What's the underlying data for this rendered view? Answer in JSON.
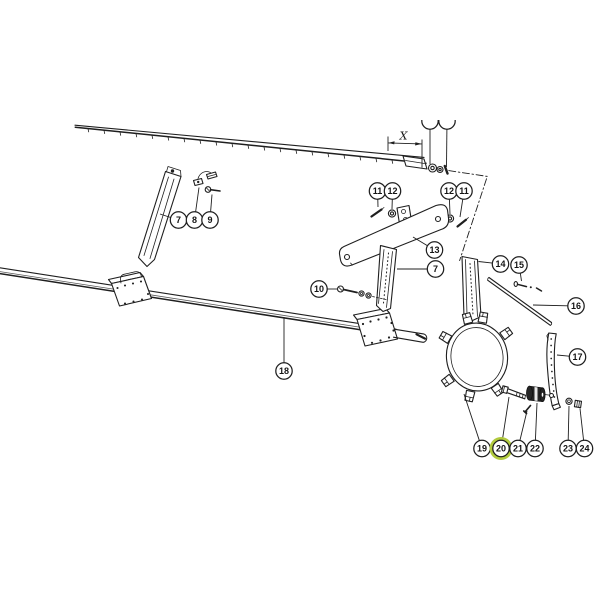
{
  "canvas": {
    "width": 600,
    "height": 600,
    "background": "#ffffff"
  },
  "colors": {
    "line": "#1f1f1f",
    "highlight": "#b1ca3e",
    "paper": "#ffffff"
  },
  "dimension": {
    "label": "X"
  },
  "highlighted_part": "20",
  "callouts": [
    {
      "label": "7",
      "x": 178.5,
      "y": 220,
      "tx": 160,
      "ty": 214
    },
    {
      "label": "8",
      "x": 194.5,
      "y": 220,
      "tx": 199,
      "ty": 187.5
    },
    {
      "label": "9",
      "x": 210,
      "y": 220,
      "tx": 212,
      "ty": 194.5
    },
    {
      "label": "11",
      "x": 377.5,
      "y": 191,
      "tx": 378,
      "ty": 207
    },
    {
      "label": "12",
      "x": 392.5,
      "y": 191,
      "tx": 392,
      "ty": 209
    },
    {
      "label": "12",
      "x": 449,
      "y": 191,
      "tx": 450,
      "ty": 214
    },
    {
      "label": "11",
      "x": 464,
      "y": 191,
      "tx": 460,
      "ty": 217
    },
    {
      "label": "13",
      "x": 434.5,
      "y": 250,
      "tx": 413,
      "ty": 237
    },
    {
      "label": "7",
      "x": 435.5,
      "y": 269,
      "tx": 397,
      "ty": 269
    },
    {
      "label": "10",
      "x": 319,
      "y": 289,
      "tx": 337,
      "ty": 289
    },
    {
      "label": "14",
      "x": 500.5,
      "y": 264,
      "tx": 478.5,
      "ty": 261.5
    },
    {
      "label": "15",
      "x": 519,
      "y": 265,
      "tx": 521.5,
      "ty": 281
    },
    {
      "label": "16",
      "x": 576,
      "y": 306,
      "tx": 533,
      "ty": 305
    },
    {
      "label": "17",
      "x": 577.5,
      "y": 357,
      "tx": 557,
      "ty": 355
    },
    {
      "label": "18",
      "x": 284,
      "y": 371,
      "tx": 284,
      "ty": 317
    },
    {
      "label": "19",
      "x": 482,
      "y": 448.5,
      "tx": 464,
      "ty": 394
    },
    {
      "label": "20",
      "x": 501,
      "y": 448.5,
      "tx": 509,
      "ty": 397,
      "highlighted": true
    },
    {
      "label": "21",
      "x": 518,
      "y": 448.5,
      "tx": 527,
      "ty": 411
    },
    {
      "label": "22",
      "x": 535,
      "y": 448.5,
      "tx": 537,
      "ty": 403
    },
    {
      "label": "23",
      "x": 568,
      "y": 448.5,
      "tx": 569,
      "ty": 406
    },
    {
      "label": "24",
      "x": 584.5,
      "y": 448.5,
      "tx": 580,
      "ty": 408.5
    },
    {
      "label": "",
      "x": 430,
      "y": 121,
      "tx": 430,
      "ty": 164,
      "clipped": true
    },
    {
      "label": "",
      "x": 447,
      "y": 121,
      "tx": 446.5,
      "ty": 167,
      "clipped": true
    }
  ]
}
